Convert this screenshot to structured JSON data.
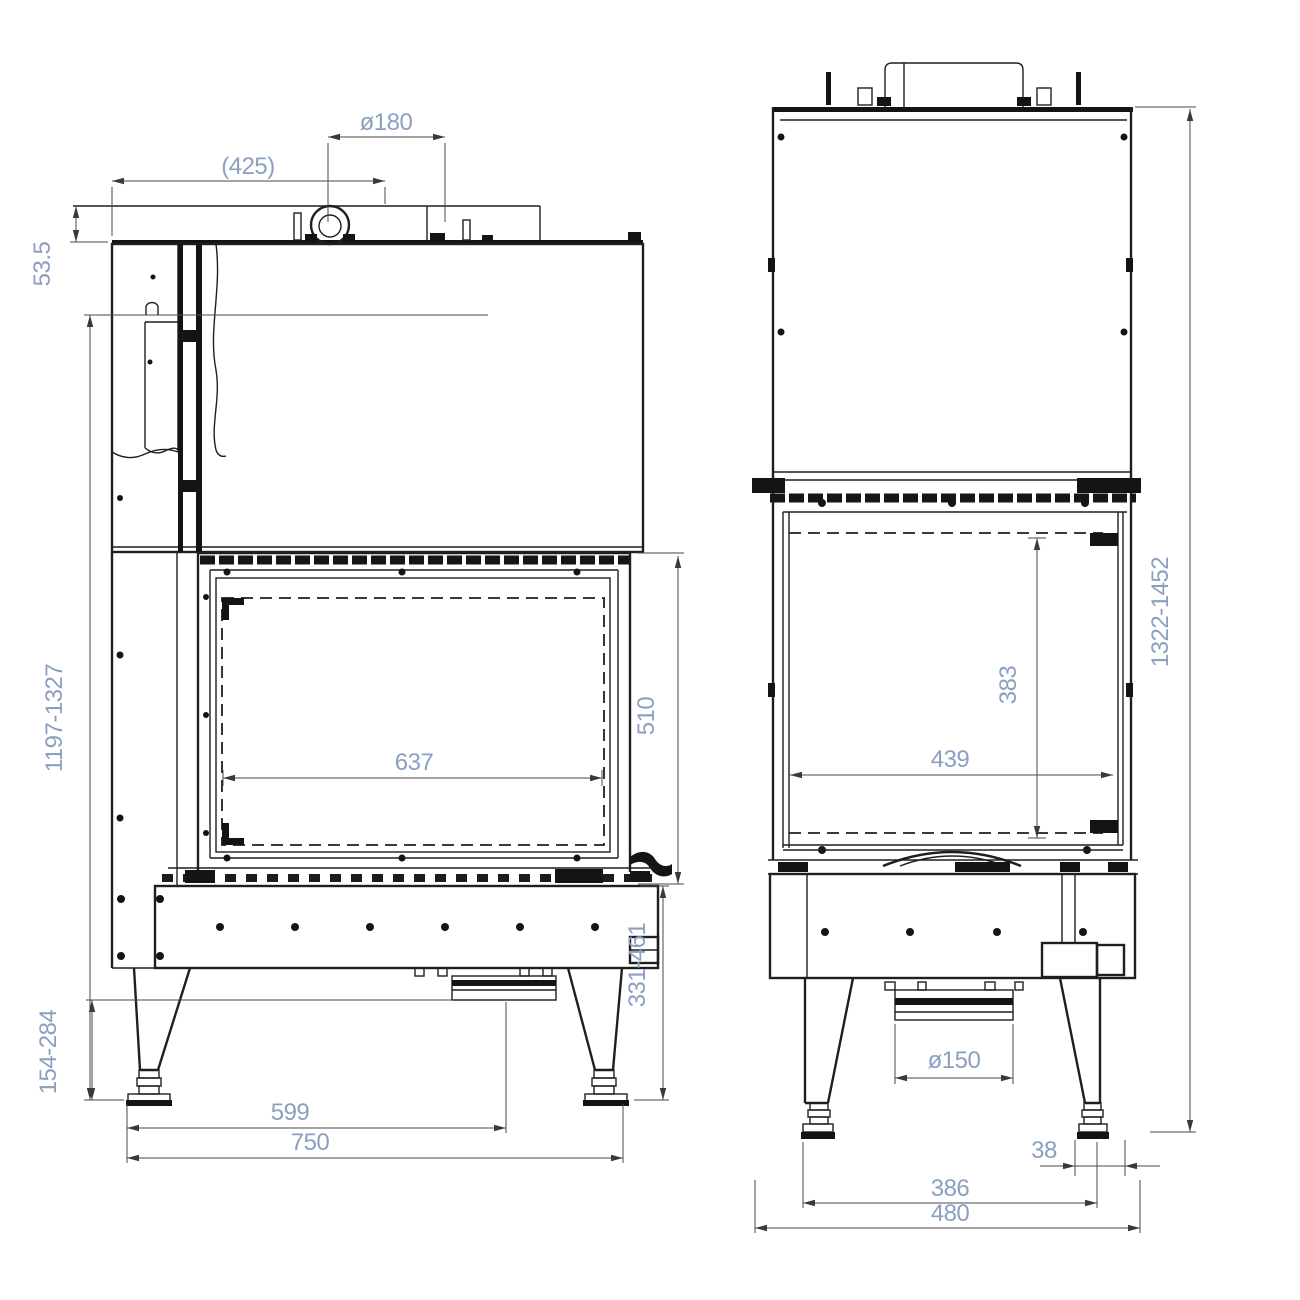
{
  "drawing": {
    "title": "fireplace-insert-technical-drawing",
    "front_view": {
      "name": "front-view",
      "dims": {
        "flue_diameter": "ø180",
        "flue_offset": "(425)",
        "top_edge": "53.5",
        "height_range": "1197-1327",
        "glass_width": "637",
        "glass_height": "510",
        "leg_clearance": "154-284",
        "base_height_range": "331-461",
        "duct_center": "599",
        "width": "750"
      }
    },
    "side_view": {
      "name": "side-view",
      "dims": {
        "height_range": "1322-1452",
        "glass_height": "383",
        "glass_depth": "439",
        "air_inlet_diameter": "ø150",
        "foot_inset": "38",
        "feet_span": "386",
        "depth": "480"
      }
    }
  }
}
